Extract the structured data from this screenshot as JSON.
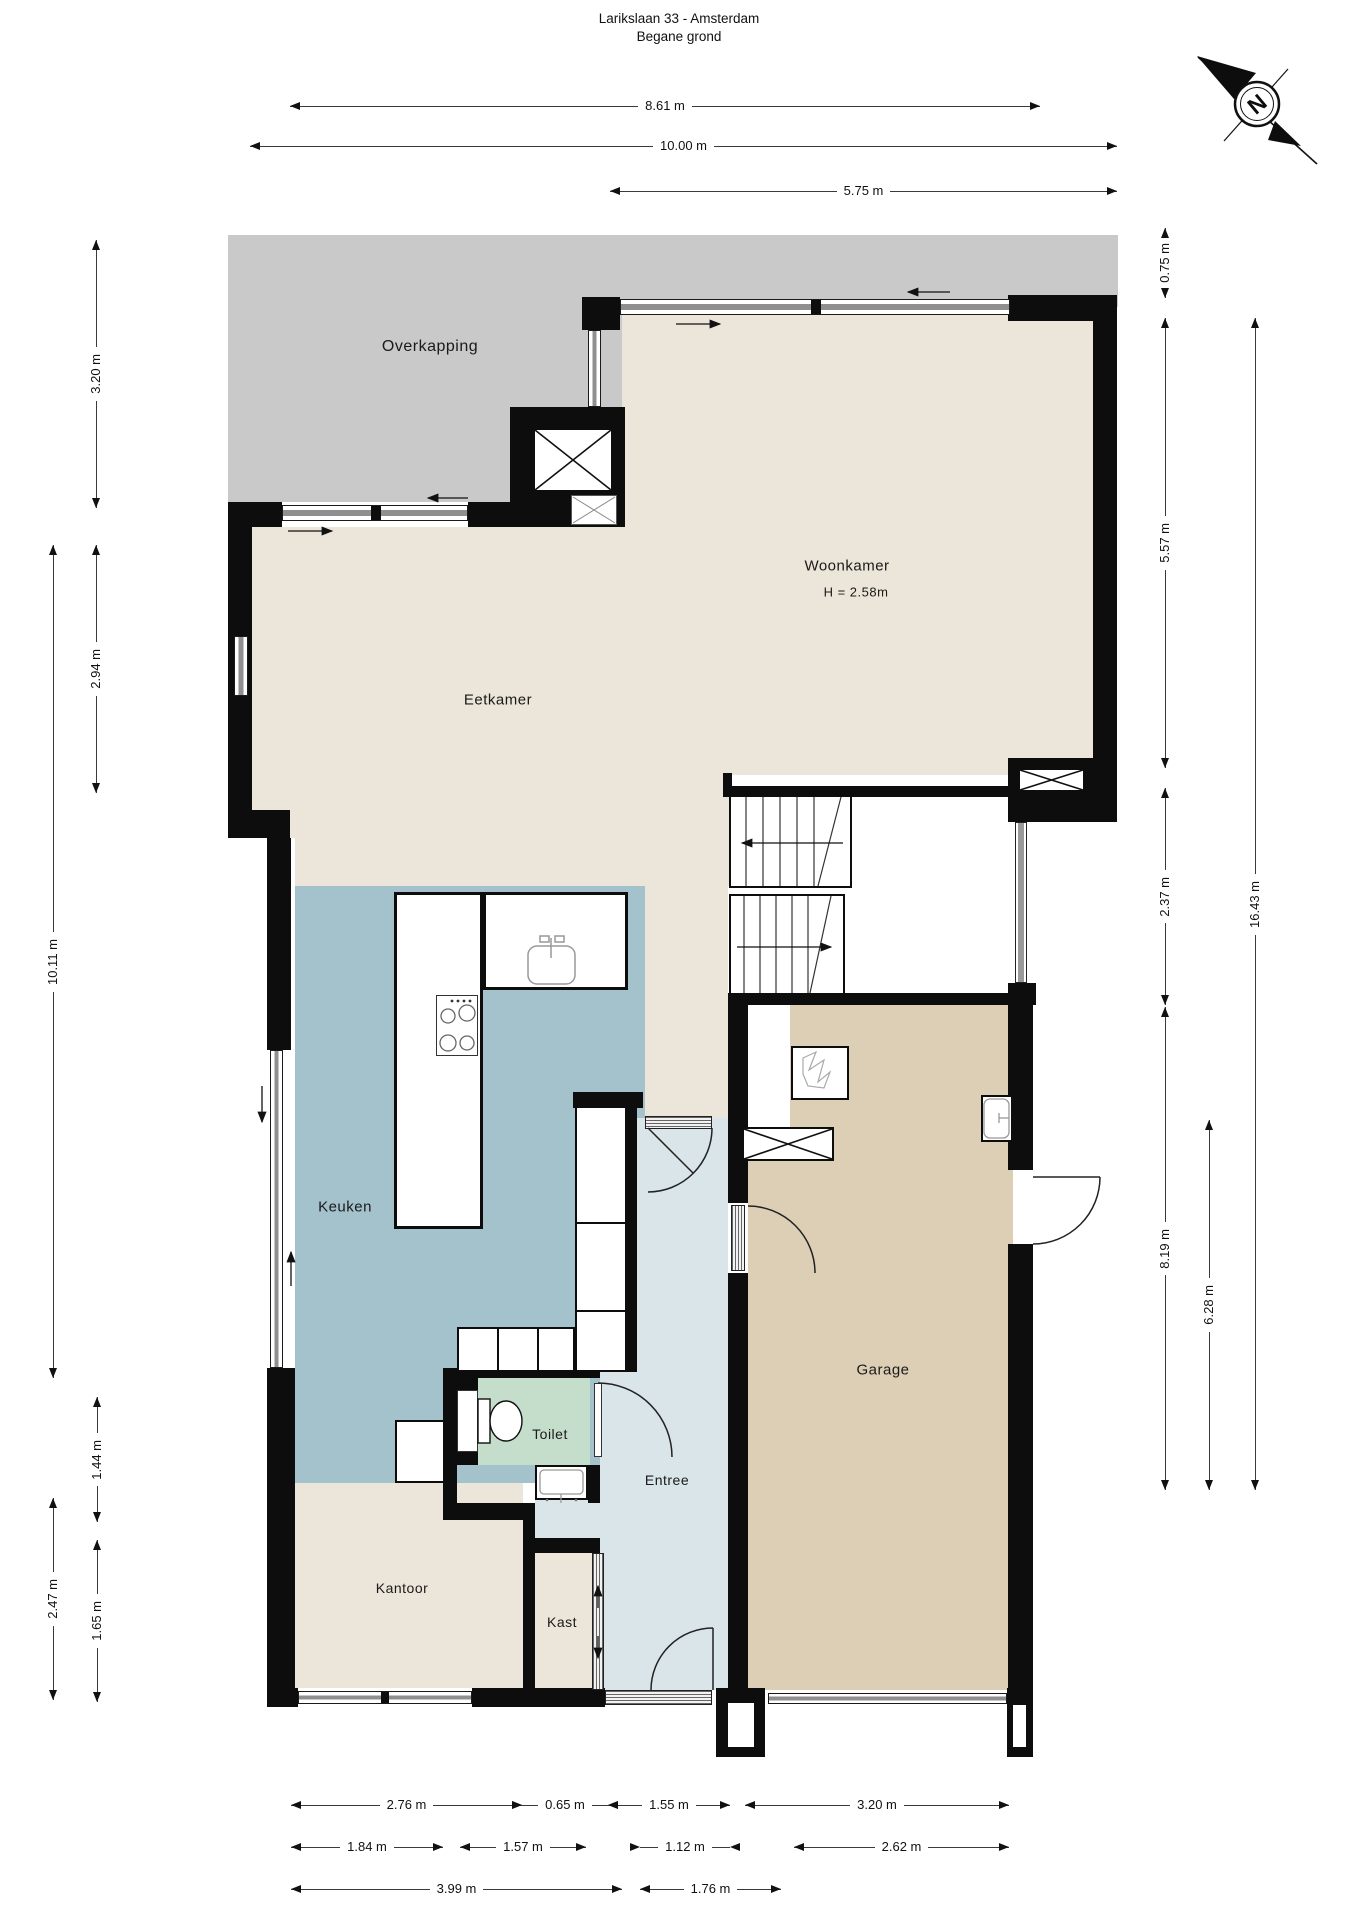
{
  "title": {
    "line1": "Larikslaan 33 - Amsterdam",
    "line2": "Begane grond"
  },
  "compass": {
    "letter": "N"
  },
  "rooms": {
    "overkapping": {
      "label": "Overkapping"
    },
    "woonkamer": {
      "label": "Woonkamer",
      "height_note": "H = 2.58m"
    },
    "eetkamer": {
      "label": "Eetkamer"
    },
    "keuken": {
      "label": "Keuken"
    },
    "toilet": {
      "label": "Toilet"
    },
    "entree": {
      "label": "Entree"
    },
    "garage": {
      "label": "Garage"
    },
    "kantoor": {
      "label": "Kantoor"
    },
    "kast": {
      "label": "Kast"
    }
  },
  "dimensions": {
    "top": [
      "8.61 m",
      "10.00 m",
      "5.75 m"
    ],
    "left": [
      "3.20 m",
      "2.94 m",
      "10.11 m",
      "1.44 m",
      "2.47 m",
      "1.65 m"
    ],
    "right": [
      "0.75 m",
      "5.57 m",
      "2.37 m",
      "16.43 m",
      "8.19 m",
      "6.28 m"
    ],
    "bottom_row1": [
      "2.76 m",
      "0.65 m",
      "1.55 m",
      "3.20 m"
    ],
    "bottom_row2": [
      "1.84 m",
      "1.57 m",
      "1.12 m",
      "2.62 m"
    ],
    "bottom_row3": [
      "3.99 m",
      "1.76 m"
    ]
  },
  "colors": {
    "wall": "#0d0d0d",
    "carport_floor": "#c9c9c9",
    "living_floor": "#ece6da",
    "kitchen_floor": "#a4c2cb",
    "hallway_floor": "#d9e5e8",
    "toilet_floor": "#c5decb",
    "garage_floor": "#ddcfb5"
  }
}
